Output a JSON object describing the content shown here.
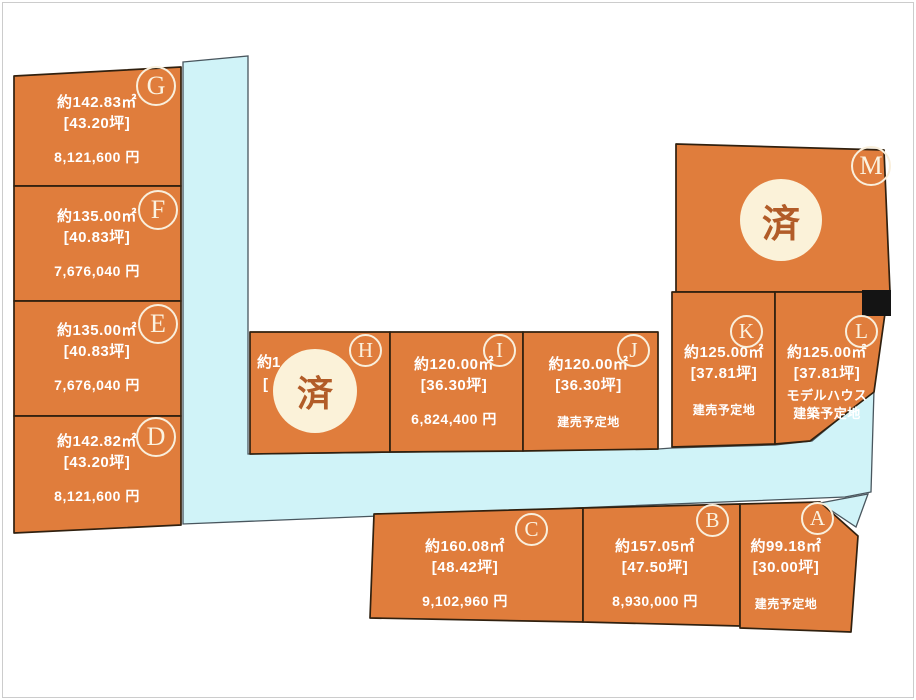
{
  "colors": {
    "plot_fill": "#e07d3c",
    "plot_border": "#30200f",
    "road_fill": "#d0f3f8",
    "road_border": "#49565e",
    "sold_circle_fill": "#fbf2d9",
    "sold_text_color": "#b25c28",
    "badge_ring_color": "#f9efdc",
    "text_color": "#ffffff",
    "marker_color": "#141414"
  },
  "plots": [
    {
      "id": "G",
      "area": "約142.83㎡",
      "tsubo": "[43.20坪]",
      "price": "8,121,600 円"
    },
    {
      "id": "F",
      "area": "約135.00㎡",
      "tsubo": "[40.83坪]",
      "price": "7,676,040 円"
    },
    {
      "id": "E",
      "area": "約135.00㎡",
      "tsubo": "[40.83坪]",
      "price": "7,676,040 円"
    },
    {
      "id": "D",
      "area": "約142.82㎡",
      "tsubo": "[43.20坪]",
      "price": "8,121,600 円"
    },
    {
      "id": "M",
      "status": "済"
    },
    {
      "id": "H",
      "status": "済",
      "area_fragment": "約1",
      "tsubo_fragment": "["
    },
    {
      "id": "I",
      "area": "約120.00㎡",
      "tsubo": "[36.30坪]",
      "price": "6,824,400 円"
    },
    {
      "id": "J",
      "area": "約120.00㎡",
      "tsubo": "[36.30坪]",
      "note": "建売予定地"
    },
    {
      "id": "K",
      "area": "約125.00㎡",
      "tsubo": "[37.81坪]",
      "note": "建売予定地"
    },
    {
      "id": "L",
      "area": "約125.00㎡",
      "tsubo": "[37.81坪]",
      "note_line1": "モデルハウス",
      "note_line2": "建築予定地"
    },
    {
      "id": "C",
      "area": "約160.08㎡",
      "tsubo": "[48.42坪]",
      "price": "9,102,960 円"
    },
    {
      "id": "B",
      "area": "約157.05㎡",
      "tsubo": "[47.50坪]",
      "price": "8,930,000 円"
    },
    {
      "id": "A",
      "area": "約99.18㎡",
      "tsubo": "[30.00坪]",
      "note": "建売予定地"
    }
  ]
}
